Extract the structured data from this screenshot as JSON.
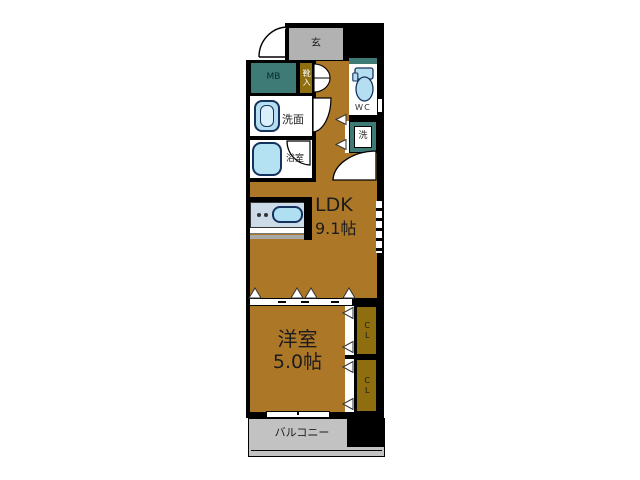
{
  "floorplan": {
    "entrance": {
      "label": "玄"
    },
    "meter_box": {
      "label": "MB"
    },
    "shoe_cabinet": {
      "label": "靴入"
    },
    "toilet": {
      "label": "ＷＣ"
    },
    "washroom": {
      "label": "洗面"
    },
    "bathroom": {
      "label": "浴室"
    },
    "laundry": {
      "label": "洗"
    },
    "ldk": {
      "label": "LDK",
      "size": "9.1帖"
    },
    "western_room": {
      "label": "洋室",
      "size": "5.0帖"
    },
    "closet_upper": {
      "label": "CL"
    },
    "closet_lower": {
      "label": "CL"
    },
    "balcony": {
      "label": "バルコニー"
    }
  },
  "colors": {
    "wall_black": "#000000",
    "floor_wood_brown": "#ad7728",
    "closet_olive": "#8f6e10",
    "utility_teal": "#3e7b76",
    "entrance_gray": "#b2b2b2",
    "balcony_gray": "#c2c2c2",
    "fixture_light_blue": "#b5dff0",
    "counter_gray_blue": "#ccdbe7",
    "fixture_outline_navy": "#14325e"
  }
}
